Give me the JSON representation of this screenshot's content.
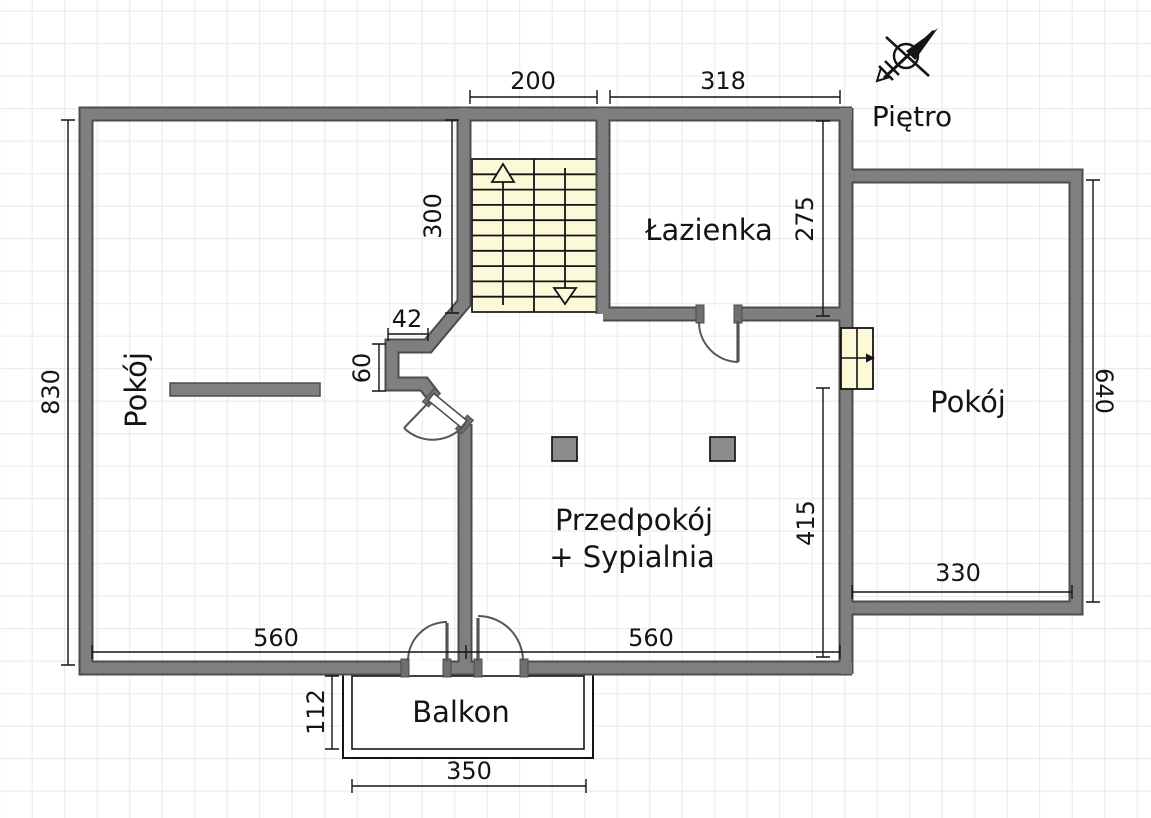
{
  "plan": {
    "floor_title": "Piętro",
    "rooms": {
      "room_left": "Pokój",
      "bathroom": "Łazienka",
      "room_right": "Pokój",
      "hall_line1": "Przedpokój",
      "hall_line2": "+ Sypialnia",
      "balcony": "Balkon"
    },
    "dimensions": {
      "stairs_width": "200",
      "bathroom_width": "318",
      "left_height": "830",
      "stairs_depth": "300",
      "bathroom_height": "275",
      "nook_width": "42",
      "nook_height": "60",
      "hall_height": "415",
      "right_room_height": "640",
      "right_room_width": "330",
      "bottom_left_width": "560",
      "bottom_right_width": "560",
      "balcony_depth": "112",
      "balcony_width": "350"
    },
    "colors": {
      "wall_fill": "#7f7f7f",
      "wall_outline": "#4c4c4c",
      "stairs_fill": "#fcf9d8",
      "grid_line": "#e9e9e9"
    },
    "icons": {
      "north_arrow": "north-arrow-icon"
    }
  }
}
